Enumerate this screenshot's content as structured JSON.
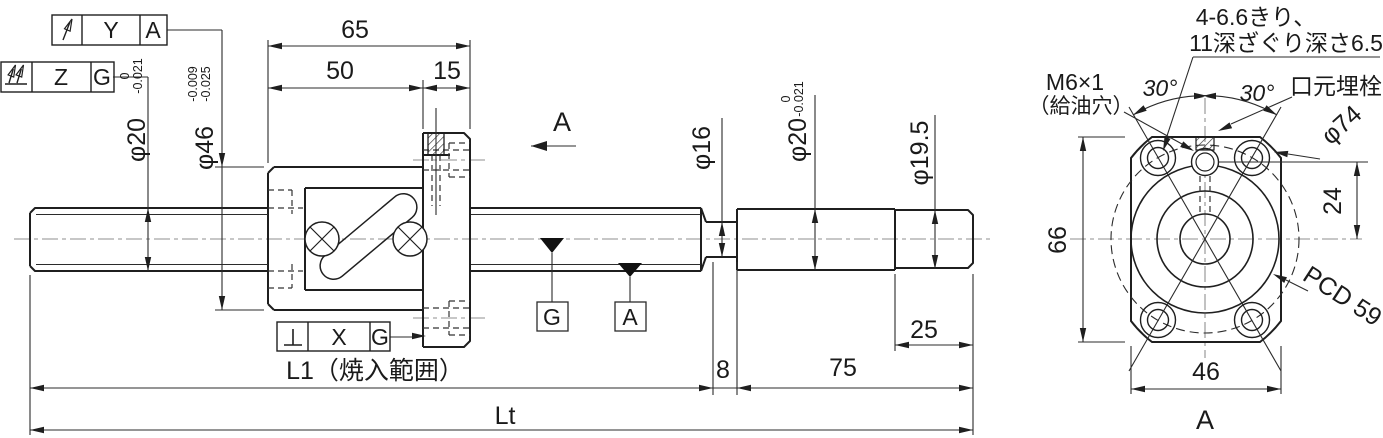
{
  "colors": {
    "line": "#1f1f1f",
    "centerline": "#8f8f8f",
    "hidden": "#333333"
  },
  "frames": {
    "ya": {
      "symbol": "circular-runout",
      "value": "Y",
      "datum": "A"
    },
    "zg": {
      "symbol": "total-runout",
      "value": "Z",
      "datum": "G"
    },
    "xg": {
      "symbol": "perpendicularity",
      "value": "X",
      "datum": "G"
    }
  },
  "side": {
    "d65": "65",
    "d50": "50",
    "d15": "15",
    "d25": "25",
    "d8": "8",
    "d75": "75",
    "l1": "L1（焼入範囲）",
    "lt": "Lt",
    "phi20l": "φ20",
    "phi20l_sup": "0",
    "phi20l_sub": "-0.021",
    "phi46": "φ46",
    "phi46_sup": "-0.009",
    "phi46_sub": "-0.025",
    "phi16": "φ16",
    "phi20r": "φ20",
    "phi20r_sup": "0",
    "phi20r_sub": "-0.021",
    "phi195": "φ19.5",
    "section_arrow": "A",
    "target_g": "G",
    "target_a": "A"
  },
  "end": {
    "d66": "66",
    "d46": "46",
    "d24": "24",
    "phi74": "φ74",
    "pcd": "PCD 59",
    "ang_left": "30°",
    "ang_right": "30°",
    "note1": "4-6.6きり、",
    "note2": "11深ざぐり深さ6.5",
    "m6": "M6×1",
    "m6b": "（給油穴）",
    "plug": "口元埋栓",
    "view_label": "A"
  }
}
